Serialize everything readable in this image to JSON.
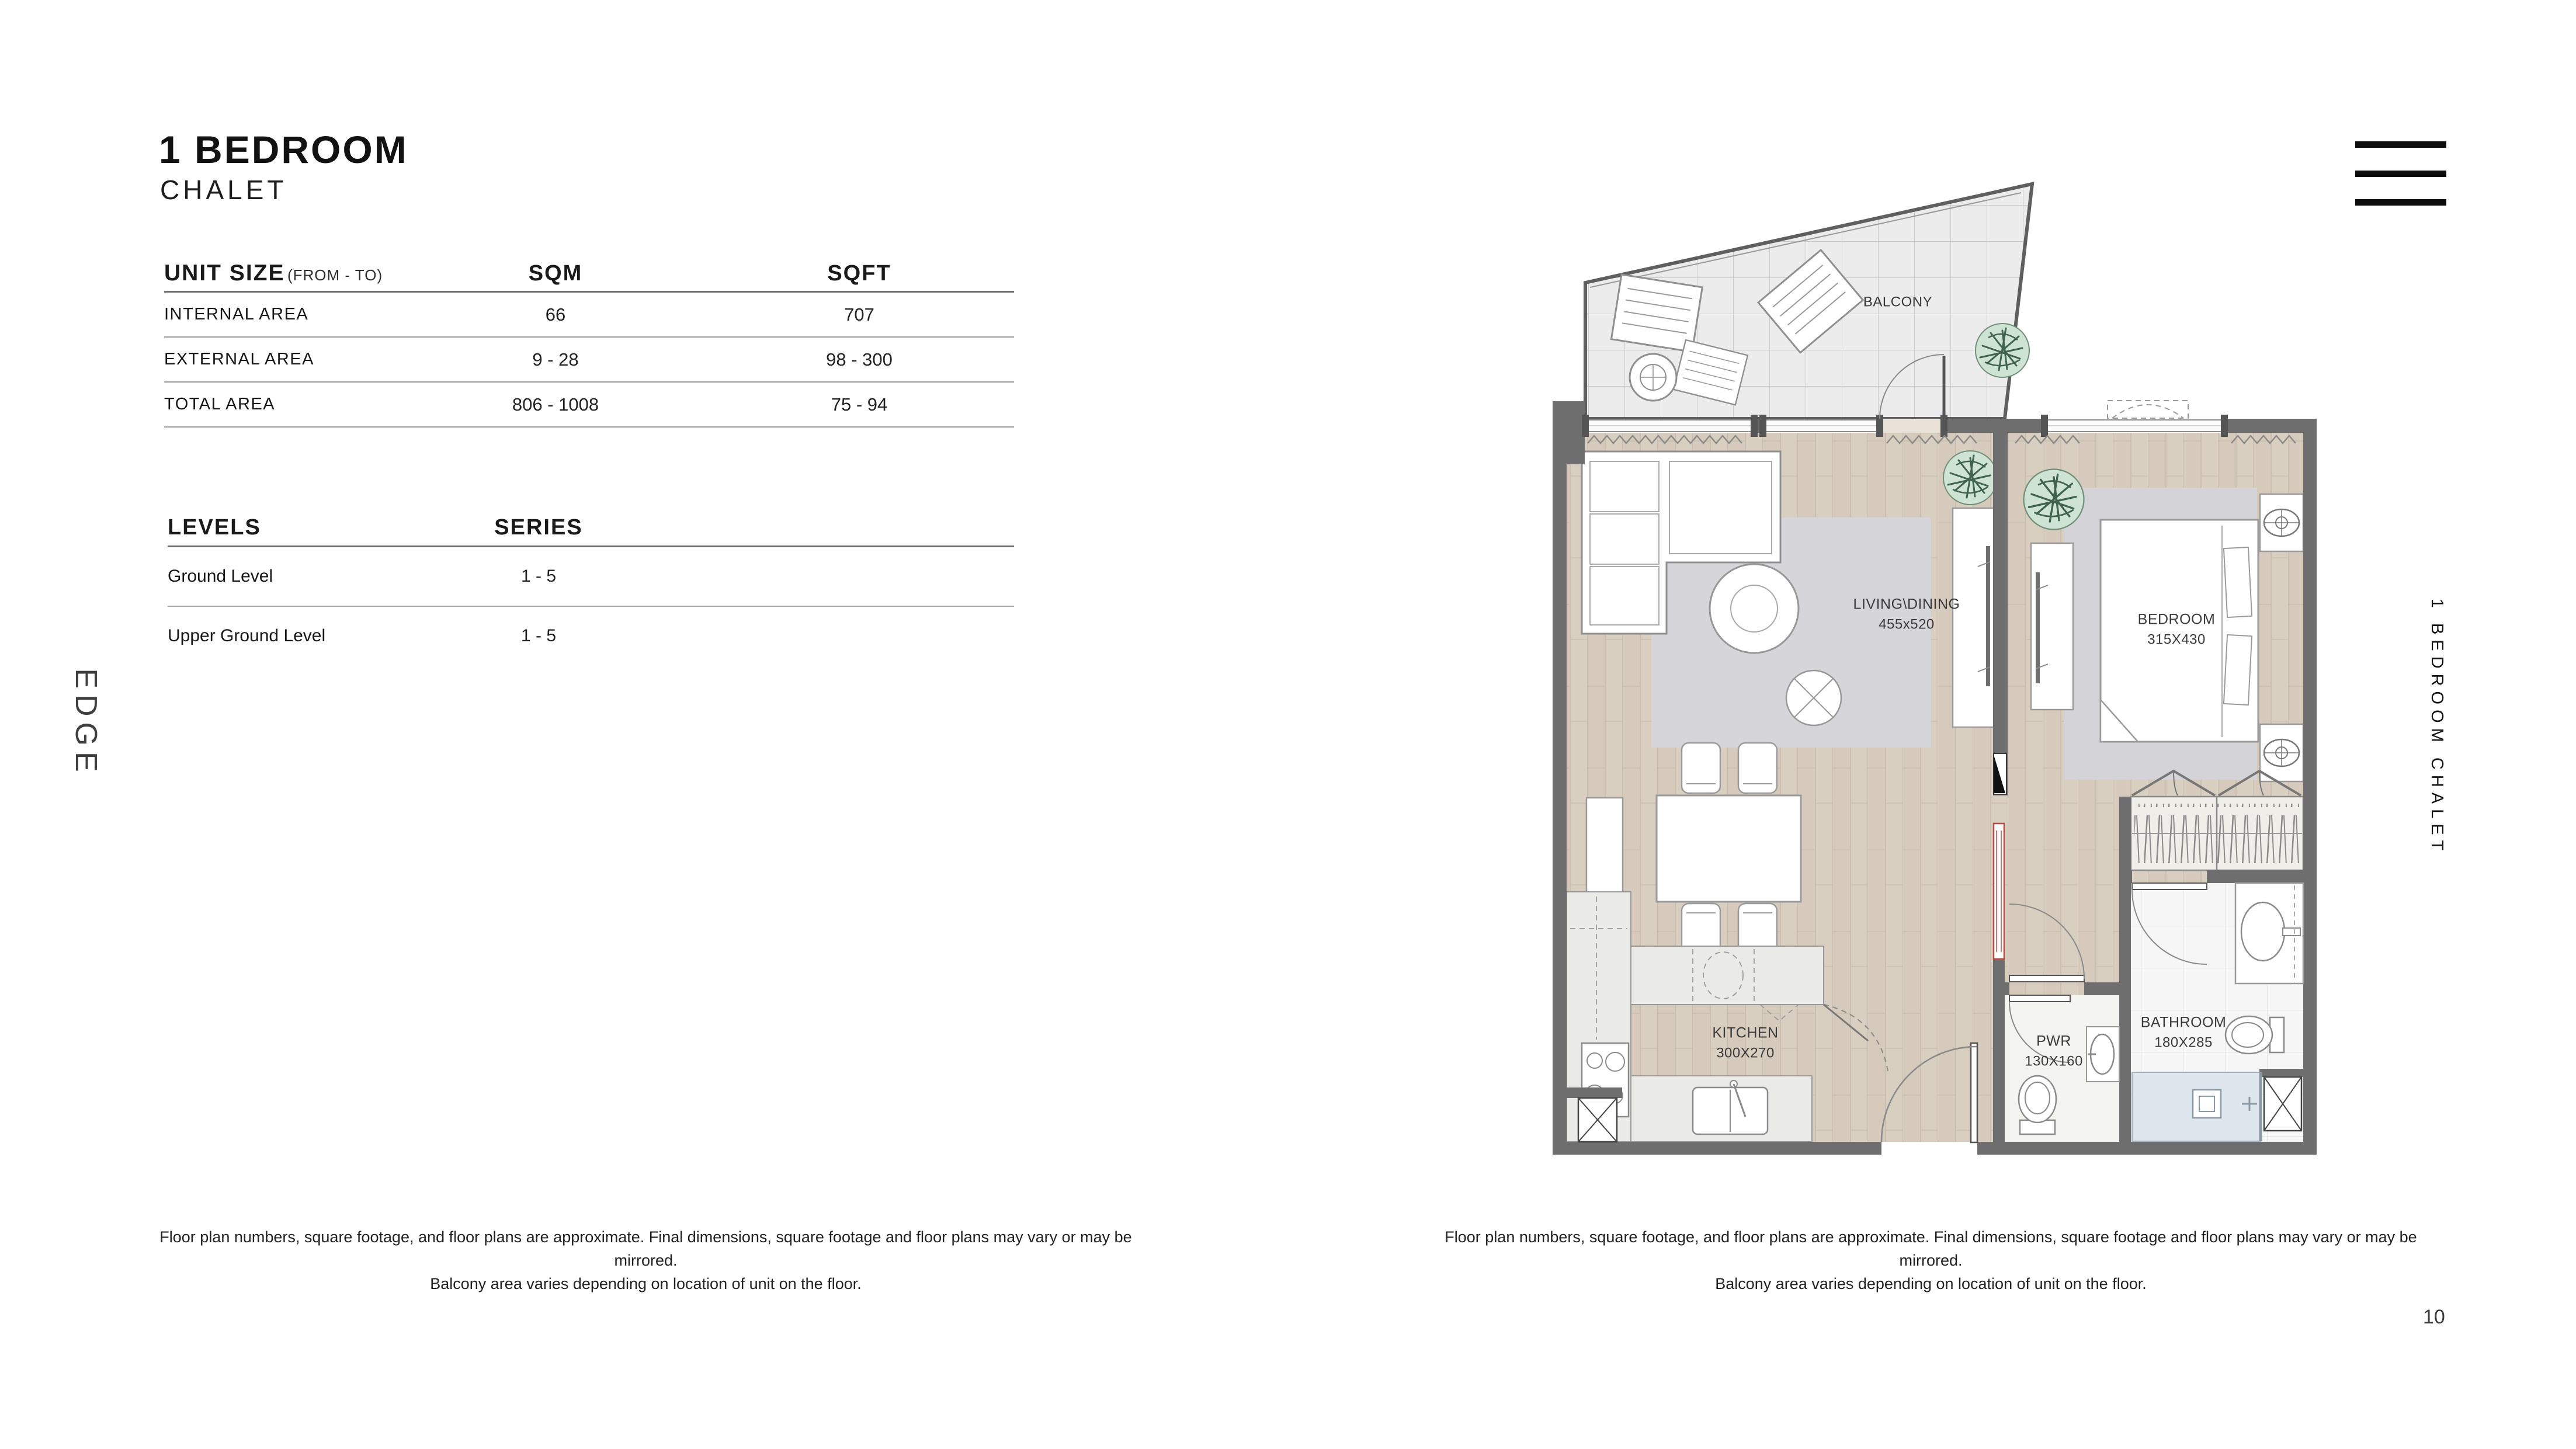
{
  "header": {
    "title": "1 BEDROOM",
    "subtitle": "CHALET"
  },
  "brand": {
    "logo": "EDGE",
    "side_label": "1 BEDROOM CHALET"
  },
  "icons": {
    "menu": "hamburger-menu"
  },
  "unit_size_table": {
    "title": "UNIT SIZE",
    "title_note": "(FROM - TO)",
    "col_sqm": "SQM",
    "col_sqft": "SQFT",
    "rows": [
      {
        "label": "INTERNAL AREA",
        "sqm": "66",
        "sqft": "707"
      },
      {
        "label": "EXTERNAL AREA",
        "sqm": "9 - 28",
        "sqft": "98 - 300"
      },
      {
        "label": "TOTAL AREA",
        "sqm": "806 - 1008",
        "sqft": "75 - 94"
      }
    ]
  },
  "levels_table": {
    "col_levels": "LEVELS",
    "col_series": "SERIES",
    "rows": [
      {
        "label": "Ground Level",
        "series": "1 - 5"
      },
      {
        "label": "Upper Ground Level",
        "series": "1 - 5"
      }
    ]
  },
  "floor_plan": {
    "balcony": {
      "name": "BALCONY"
    },
    "living": {
      "name": "LIVING\\DINING",
      "dims": "455x520"
    },
    "bedroom": {
      "name": "BEDROOM",
      "dims": "315X430"
    },
    "kitchen": {
      "name": "KITCHEN",
      "dims": "300X270"
    },
    "pwr": {
      "name": "PWR",
      "dims": "130X160"
    },
    "bathroom": {
      "name": "BATHROOM",
      "dims": "180X285"
    }
  },
  "footer": {
    "disclaimer_line1": "Floor plan numbers, square footage, and floor plans are approximate. Final dimensions, square footage and floor plans may vary or may be mirrored.",
    "disclaimer_line2": "Balcony area varies depending on location of unit on the floor.",
    "page_number": "10"
  }
}
